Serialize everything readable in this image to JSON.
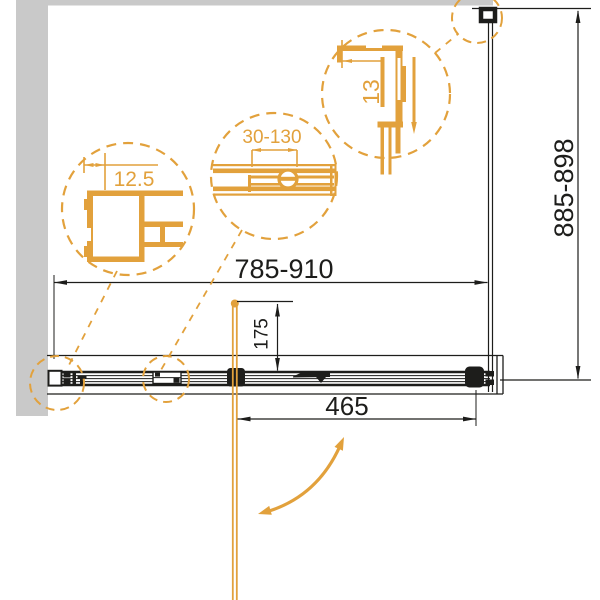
{
  "drawing": {
    "dimensions": {
      "width_range": "785-910",
      "height_range": "885-898",
      "door_opening": "465",
      "handle_offset": "175"
    },
    "details": {
      "wall_profile_gap": "12.5",
      "adjustment_range": "30-130",
      "top_rail_depth": "13"
    },
    "icons": {
      "door_swing": "curved-double-arrow",
      "slide_direction": "down-arrow"
    },
    "colors": {
      "accent_orange": "#e2a13c",
      "wall_gray": "#c9c9c9",
      "line_black": "#1d1d1b"
    }
  }
}
